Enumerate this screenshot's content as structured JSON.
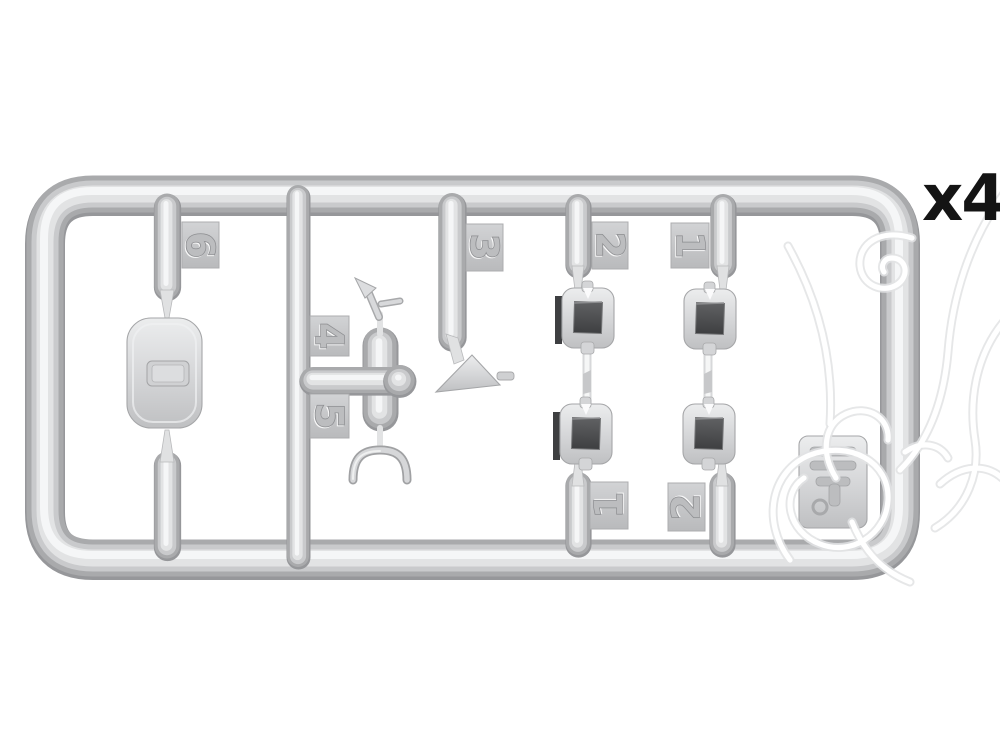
{
  "photo": {
    "background_color": "#ffffff",
    "subject": "grey injection-molded plastic model sprue with numbered parts",
    "quantity_label": "x4",
    "quantity_color": "#141414"
  },
  "sprue": {
    "plastic_color": "#cdced0",
    "plastic_highlight": "#f5f6f7",
    "plastic_shadow": "#96979a",
    "window_dark_color": "#4b4c4e",
    "tags": [
      {
        "label": "6",
        "position": "left-column-top"
      },
      {
        "label": "4",
        "position": "center-upper"
      },
      {
        "label": "5",
        "position": "center-lower"
      },
      {
        "label": "3",
        "position": "middle-top"
      },
      {
        "label": "2",
        "position": "right-section-top-left"
      },
      {
        "label": "1",
        "position": "right-section-top-right"
      },
      {
        "label": "1",
        "position": "right-section-bottom-left"
      },
      {
        "label": "2",
        "position": "right-section-bottom-right"
      }
    ],
    "parts": [
      {
        "name": "rounded hatch plate",
        "tag": "6"
      },
      {
        "name": "small lever with pin",
        "tag": "4"
      },
      {
        "name": "u-shaped grab handle",
        "tag": "5"
      },
      {
        "name": "triangular bracket with pin",
        "tag": "3"
      },
      {
        "name": "periscope housing with dark window",
        "tag": "2",
        "count": 2
      },
      {
        "name": "periscope housing with dark window",
        "tag": "1",
        "count": 2
      },
      {
        "name": "embossed sprue id plate",
        "tag": ""
      }
    ]
  },
  "watermark": {
    "style": "white line-art overlay",
    "color": "#ffffff"
  }
}
